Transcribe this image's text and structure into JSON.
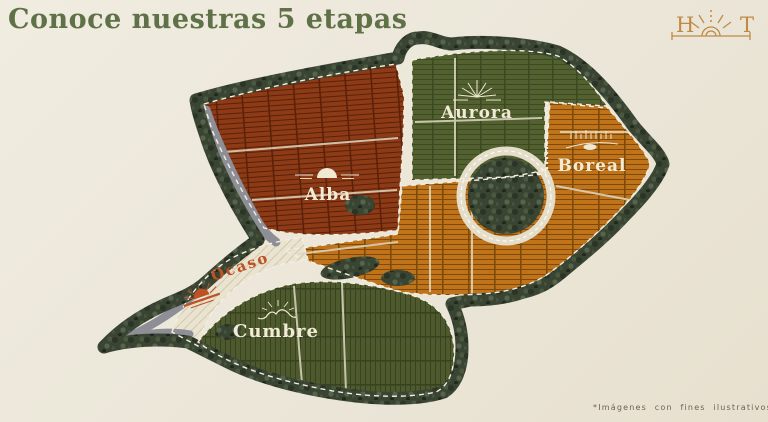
{
  "page": {
    "title": "Conoce nuestras 5 etapas",
    "footnote": "*Imágenes con fines ilustrativos"
  },
  "logo": {
    "letter_left": "H",
    "letter_right": "T",
    "icon": "rising-sun-icon",
    "color": "#c08a45"
  },
  "stages": [
    {
      "id": "aurora",
      "name": "Aurora",
      "icon": "sunburst-icon",
      "color": "#53602f",
      "label_color": "#f1ead6"
    },
    {
      "id": "boreal",
      "name": "Boreal",
      "icon": "aurora-borealis-icon",
      "color": "#c07319",
      "label_color": "#f1ead6"
    },
    {
      "id": "alba",
      "name": "Alba",
      "icon": "sunrise-icon",
      "color": "#8d3b16",
      "label_color": "#f1ead6"
    },
    {
      "id": "ocaso",
      "name": "Ocaso",
      "icon": "sunset-icon",
      "color": "#e9e3d0",
      "label_color": "#bd5224"
    },
    {
      "id": "cumbre",
      "name": "Cumbre",
      "icon": "mountain-sun-icon",
      "color": "#4e5a2e",
      "label_color": "#f1ead6"
    }
  ],
  "map": {
    "title_color": "#5f7146",
    "tree_color": "#3a4433",
    "road_color": "#8e8e96",
    "dashed_line_color": "#f2eee0",
    "background": "#ece7da"
  }
}
